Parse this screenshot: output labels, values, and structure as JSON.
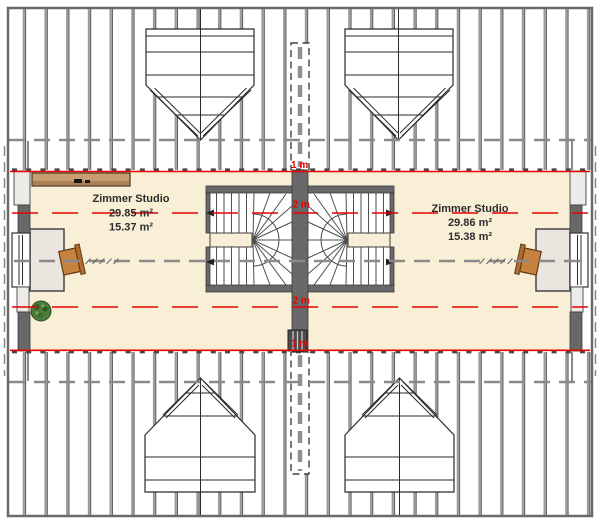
{
  "rooms": {
    "left": {
      "name": "Zimmer Studio",
      "area_total": "29.85 m²",
      "area_reduced": "15.37 m²"
    },
    "right": {
      "name": "Zimmer Studio",
      "area_total": "29.86 m²",
      "area_reduced": "15.38 m²"
    }
  },
  "height_markers": {
    "top_1m": "1 m",
    "top_2m": "2 m",
    "bottom_2m": "2 m",
    "bottom_1m": "1 m"
  },
  "colors": {
    "floor": "#F8EFD6",
    "wall": "#686868",
    "red": "#E80000",
    "dash": "#8A8A8A",
    "border": "#6A6A6A",
    "sideboard": "#C79E72",
    "sideboard_shade": "#AA8054",
    "desk": "#EAE5DF",
    "chair": "#C8823F",
    "chair_back": "#B06F2F",
    "plant": "#4E7B3A",
    "hatch_gray": "#9A9A9A",
    "hatch_dark": "#3F3F3F"
  }
}
